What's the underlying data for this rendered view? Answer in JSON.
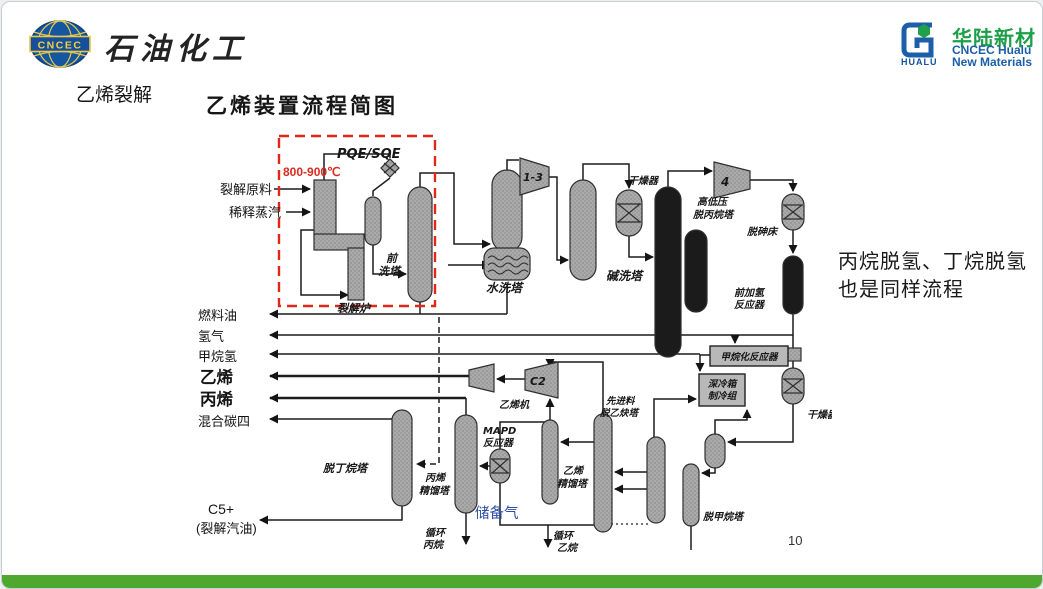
{
  "header": {
    "brand_left": {
      "badge": "CNCEC",
      "title": "石油化工"
    },
    "brand_right": {
      "icon_word": "HUALU",
      "name_cn": "华陆新材",
      "name_en1": "CNCEC Hualu",
      "name_en2": "New Materials"
    }
  },
  "slide": {
    "topic": "乙烯裂解",
    "title": "乙烯装置流程简图",
    "note_line1": "丙烷脱氢、丁烷脱氢",
    "note_line2": "也是同样流程",
    "page_number": "10"
  },
  "diagram": {
    "annotations": {
      "pqe": "PQE/SQE",
      "temp": "800-900℃"
    },
    "streams": {
      "feed": "裂解原料",
      "steam": "稀释蒸汽",
      "fuel_oil": "燃料油",
      "hydrogen": "氢气",
      "methane_h2": "甲烷氢",
      "ethylene": "乙烯",
      "propylene": "丙烯",
      "mixed_c4": "混合碳四",
      "c5": "C5+",
      "c5_sub": "(裂解汽油)",
      "reserve_gas": "储备气",
      "recycle_propane1": "循环",
      "recycle_propane2": "丙烷",
      "recycle_ethane1": "循环",
      "recycle_ethane2": "乙烷"
    },
    "equipment": {
      "furnace": "裂解炉",
      "prewash1": "前",
      "prewash2": "洗塔",
      "water_wash": "水洗塔",
      "comp13": "1-3",
      "caustic": "碱洗塔",
      "dryer1": "干燥器",
      "depro1": "高低压",
      "depro2": "脱丙烷塔",
      "comp4": "4",
      "dearsenic": "脱砷床",
      "front_hydro1": "前加氢",
      "front_hydro2": "反应器",
      "methanation": "甲烷化反应器",
      "coldbox1": "深冷箱",
      "coldbox2": "制冷组",
      "dryer2": "干燥器",
      "demethanizer": "脱甲烷塔",
      "deacetylene1": "先进料",
      "deacetylene2": "脱乙炔塔",
      "c2col1": "乙烯",
      "c2col2": "精馏塔",
      "mapd1": "MAPD",
      "mapd2": "反应器",
      "c3col1": "丙烯",
      "c3col2": "精馏塔",
      "debutanizer": "脱丁烷塔",
      "eth_comp": "乙烯机",
      "compC2": "C2"
    },
    "colors": {
      "highlight_red": "#e02718",
      "reserve_gas_blue": "#2e4fa3",
      "footer_green": "#4ea72e",
      "brand_green": "#1d9f49",
      "brand_blue": "#1b5fa8"
    }
  }
}
